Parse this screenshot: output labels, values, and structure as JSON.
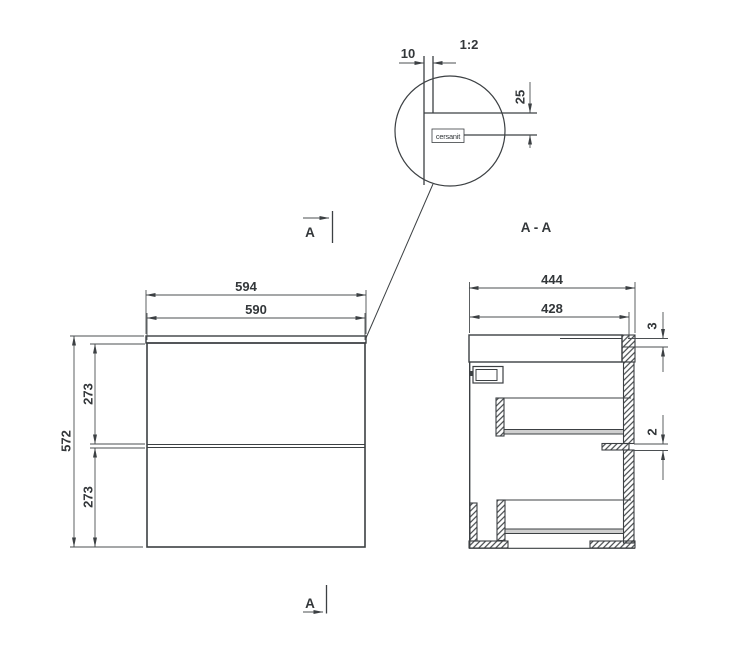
{
  "colors": {
    "background": "#ffffff",
    "line": "#3c4043",
    "dim_line": "#4b4f52",
    "text": "#33373a"
  },
  "drawing": {
    "detail_circle": {
      "scale_label": "1:2",
      "edge_offset": "10",
      "front_thickness": "25",
      "brand_label": "cersanit"
    },
    "cut_markers": {
      "top_label": "A",
      "bottom_label": "A"
    },
    "front_view": {
      "width_top_panel": "594",
      "width_cabinet": "590",
      "height_total": "572",
      "height_upper_drawer": "273",
      "height_lower_drawer": "273"
    },
    "section_view": {
      "title": "A - A",
      "depth_total": "444",
      "depth_inner": "428",
      "top_panel_offset": "3",
      "drawer_front_gap": "2"
    }
  }
}
